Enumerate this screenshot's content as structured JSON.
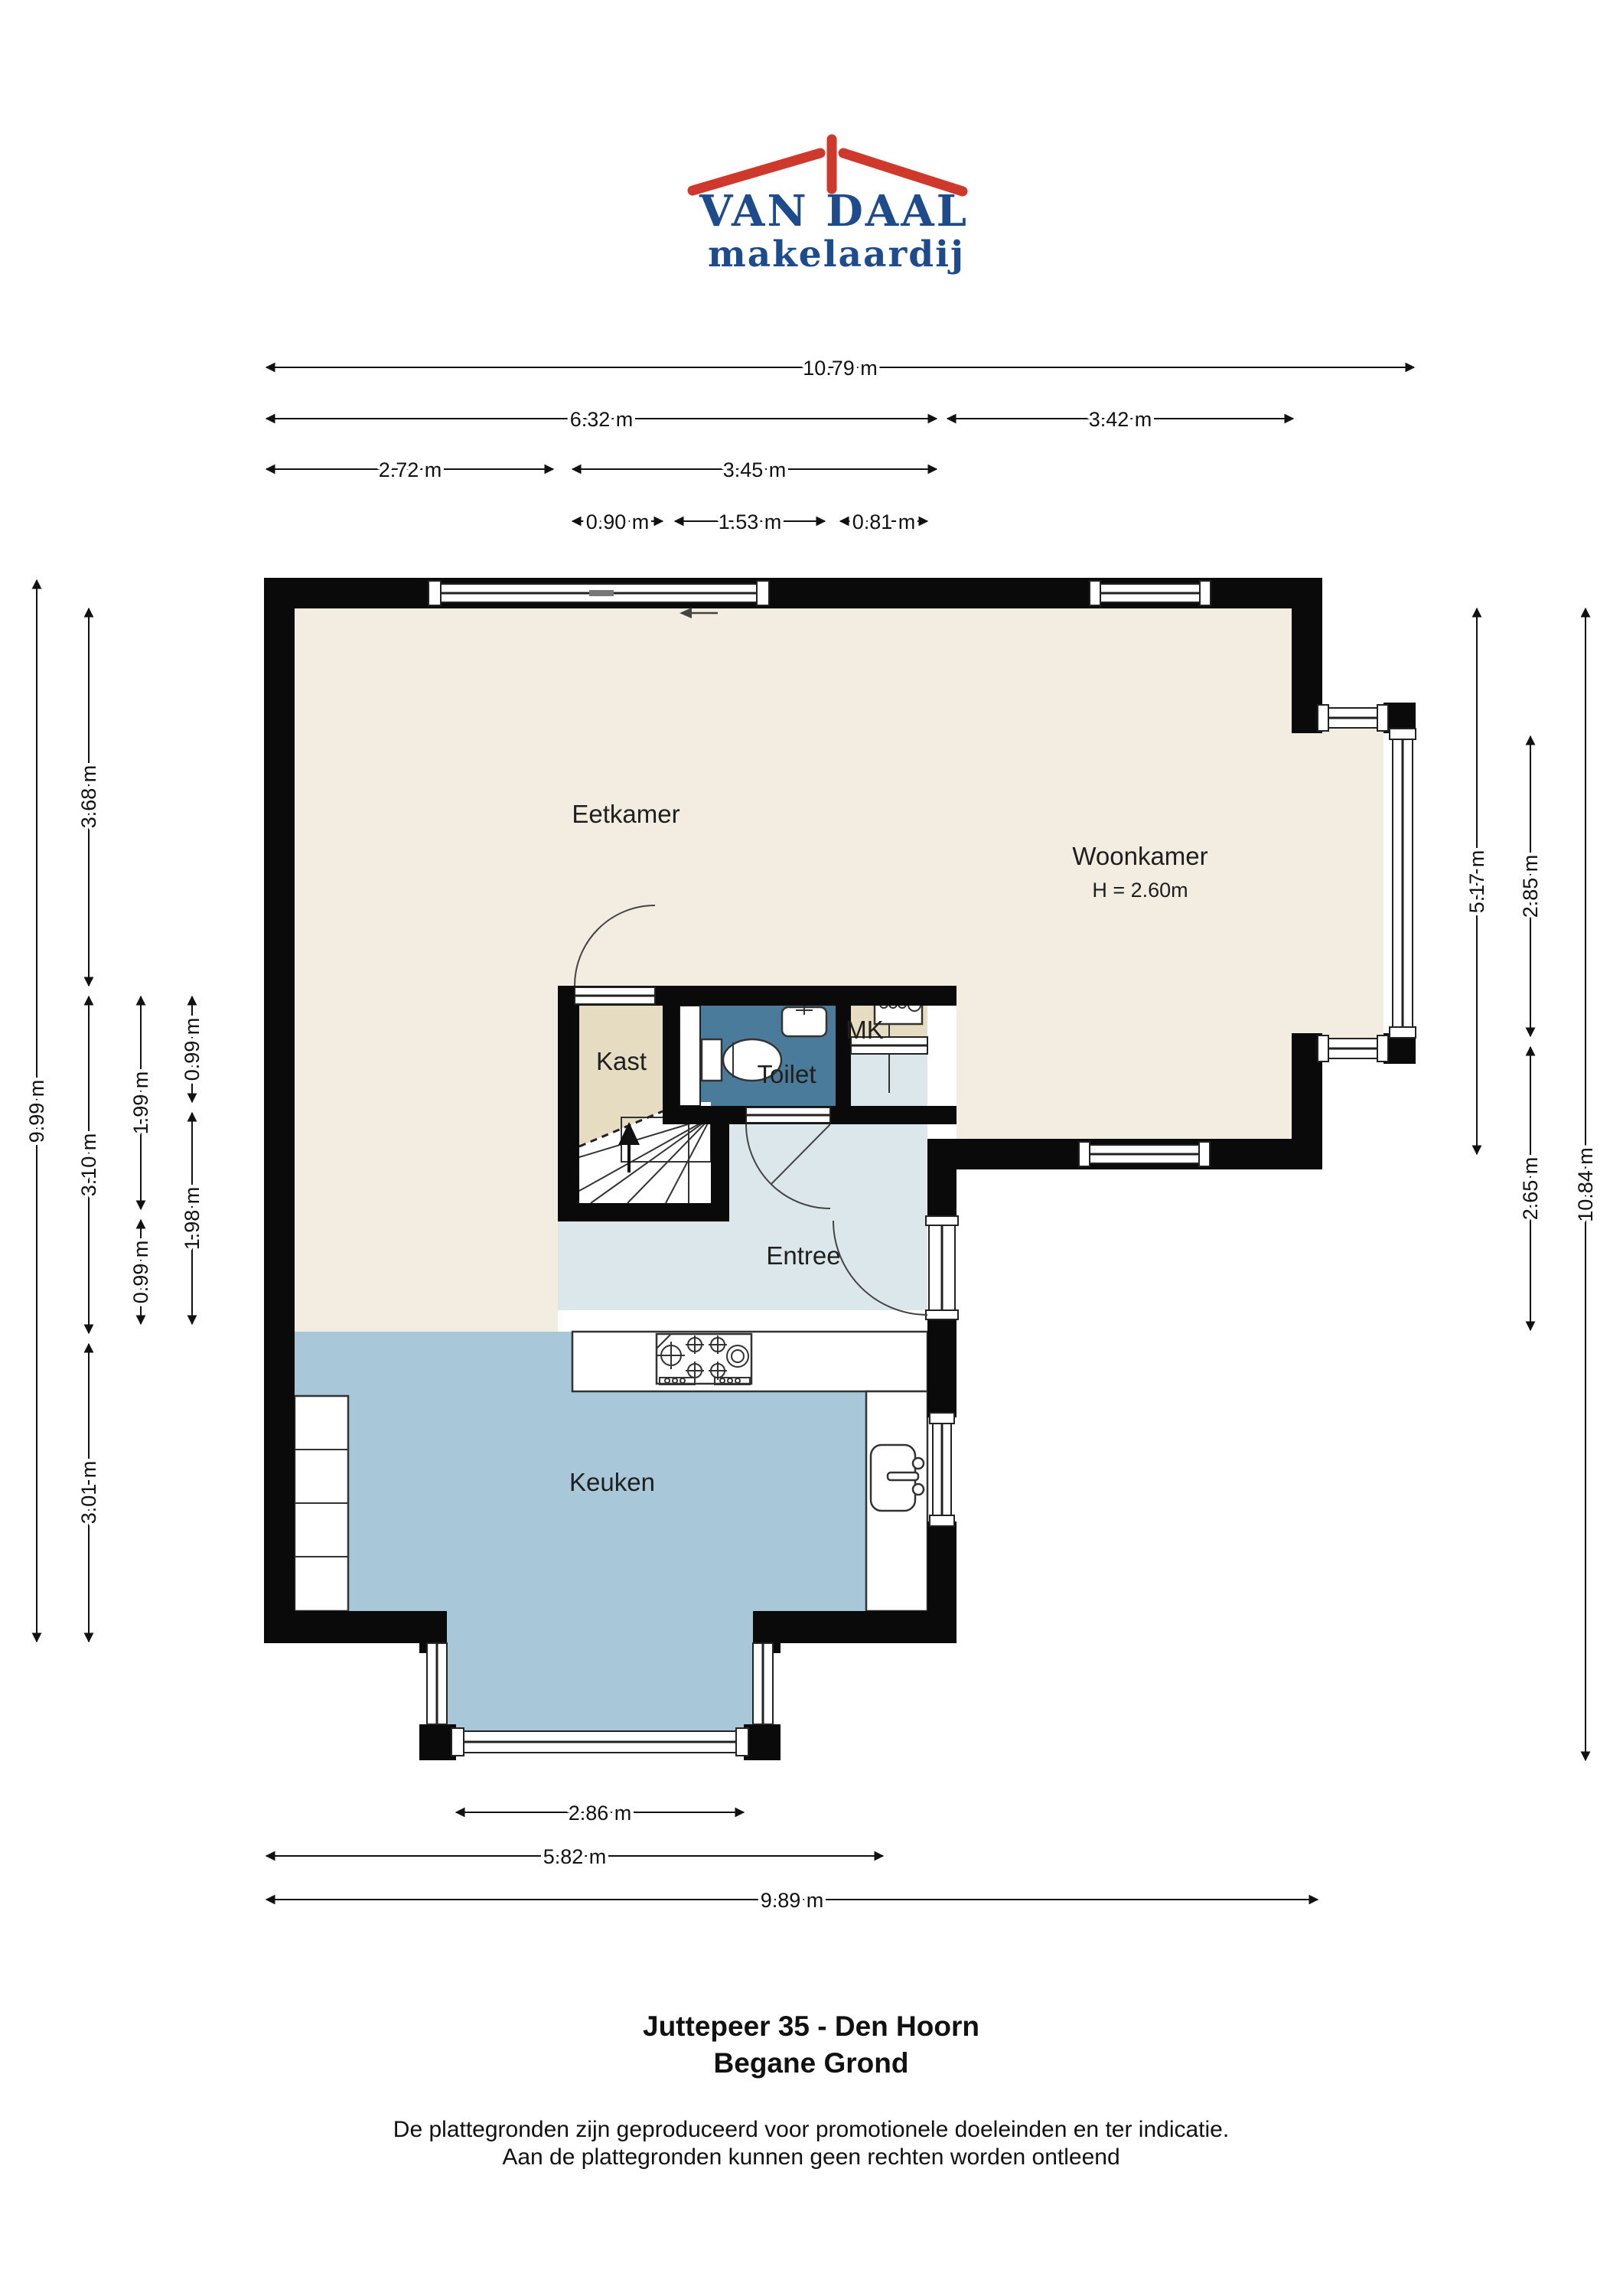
{
  "logo": {
    "name": "VAN DAAL",
    "subtitle": "makelaardij",
    "brand_blue": "#1d4b8c",
    "brand_red": "#cf392c"
  },
  "rooms": {
    "eetkamer": "Eetkamer",
    "woonkamer": "Woonkamer",
    "woonkamer_height": "H = 2.60m",
    "kast": "Kast",
    "toilet": "Toilet",
    "mk": "MK",
    "entree": "Entree",
    "keuken": "Keuken"
  },
  "dimensions": {
    "top": [
      {
        "label": "10.79 m"
      },
      {
        "label": "6.32 m"
      },
      {
        "label": "3.42 m"
      },
      {
        "label": "2.72 m"
      },
      {
        "label": "3.45 m"
      },
      {
        "label": "0.90 m"
      },
      {
        "label": "1.53 m"
      },
      {
        "label": "0.81 m"
      }
    ],
    "left": [
      {
        "label": "9.99 m"
      },
      {
        "label": "3.68 m"
      },
      {
        "label": "3.10 m"
      },
      {
        "label": "3.01 m"
      },
      {
        "label": "1.99 m"
      },
      {
        "label": "0.99 m"
      },
      {
        "label": "0.99 m"
      },
      {
        "label": "1.98 m"
      }
    ],
    "right": [
      {
        "label": "5.17 m"
      },
      {
        "label": "2.85 m"
      },
      {
        "label": "2.65 m"
      },
      {
        "label": "10.84 m"
      }
    ],
    "bottom": [
      {
        "label": "2.86 m"
      },
      {
        "label": "5.82 m"
      },
      {
        "label": "9.89 m"
      }
    ]
  },
  "footer": {
    "title_line1": "Juttepeer 35 - Den Hoorn",
    "title_line2": "Begane Grond",
    "disclaimer_line1": "De plattegronden zijn geproduceerd voor promotionele doeleinden en ter indicatie.",
    "disclaimer_line2": "Aan de plattegronden kunnen geen rechten worden ontleend"
  },
  "colors": {
    "wall": "#0a0a0a",
    "floor_living": "#f2ece1",
    "floor_kitchen": "#a8c7d8",
    "floor_entree": "#dbe7eb",
    "floor_toilet": "#4a7b9b",
    "floor_closet": "#e6dcc2"
  }
}
